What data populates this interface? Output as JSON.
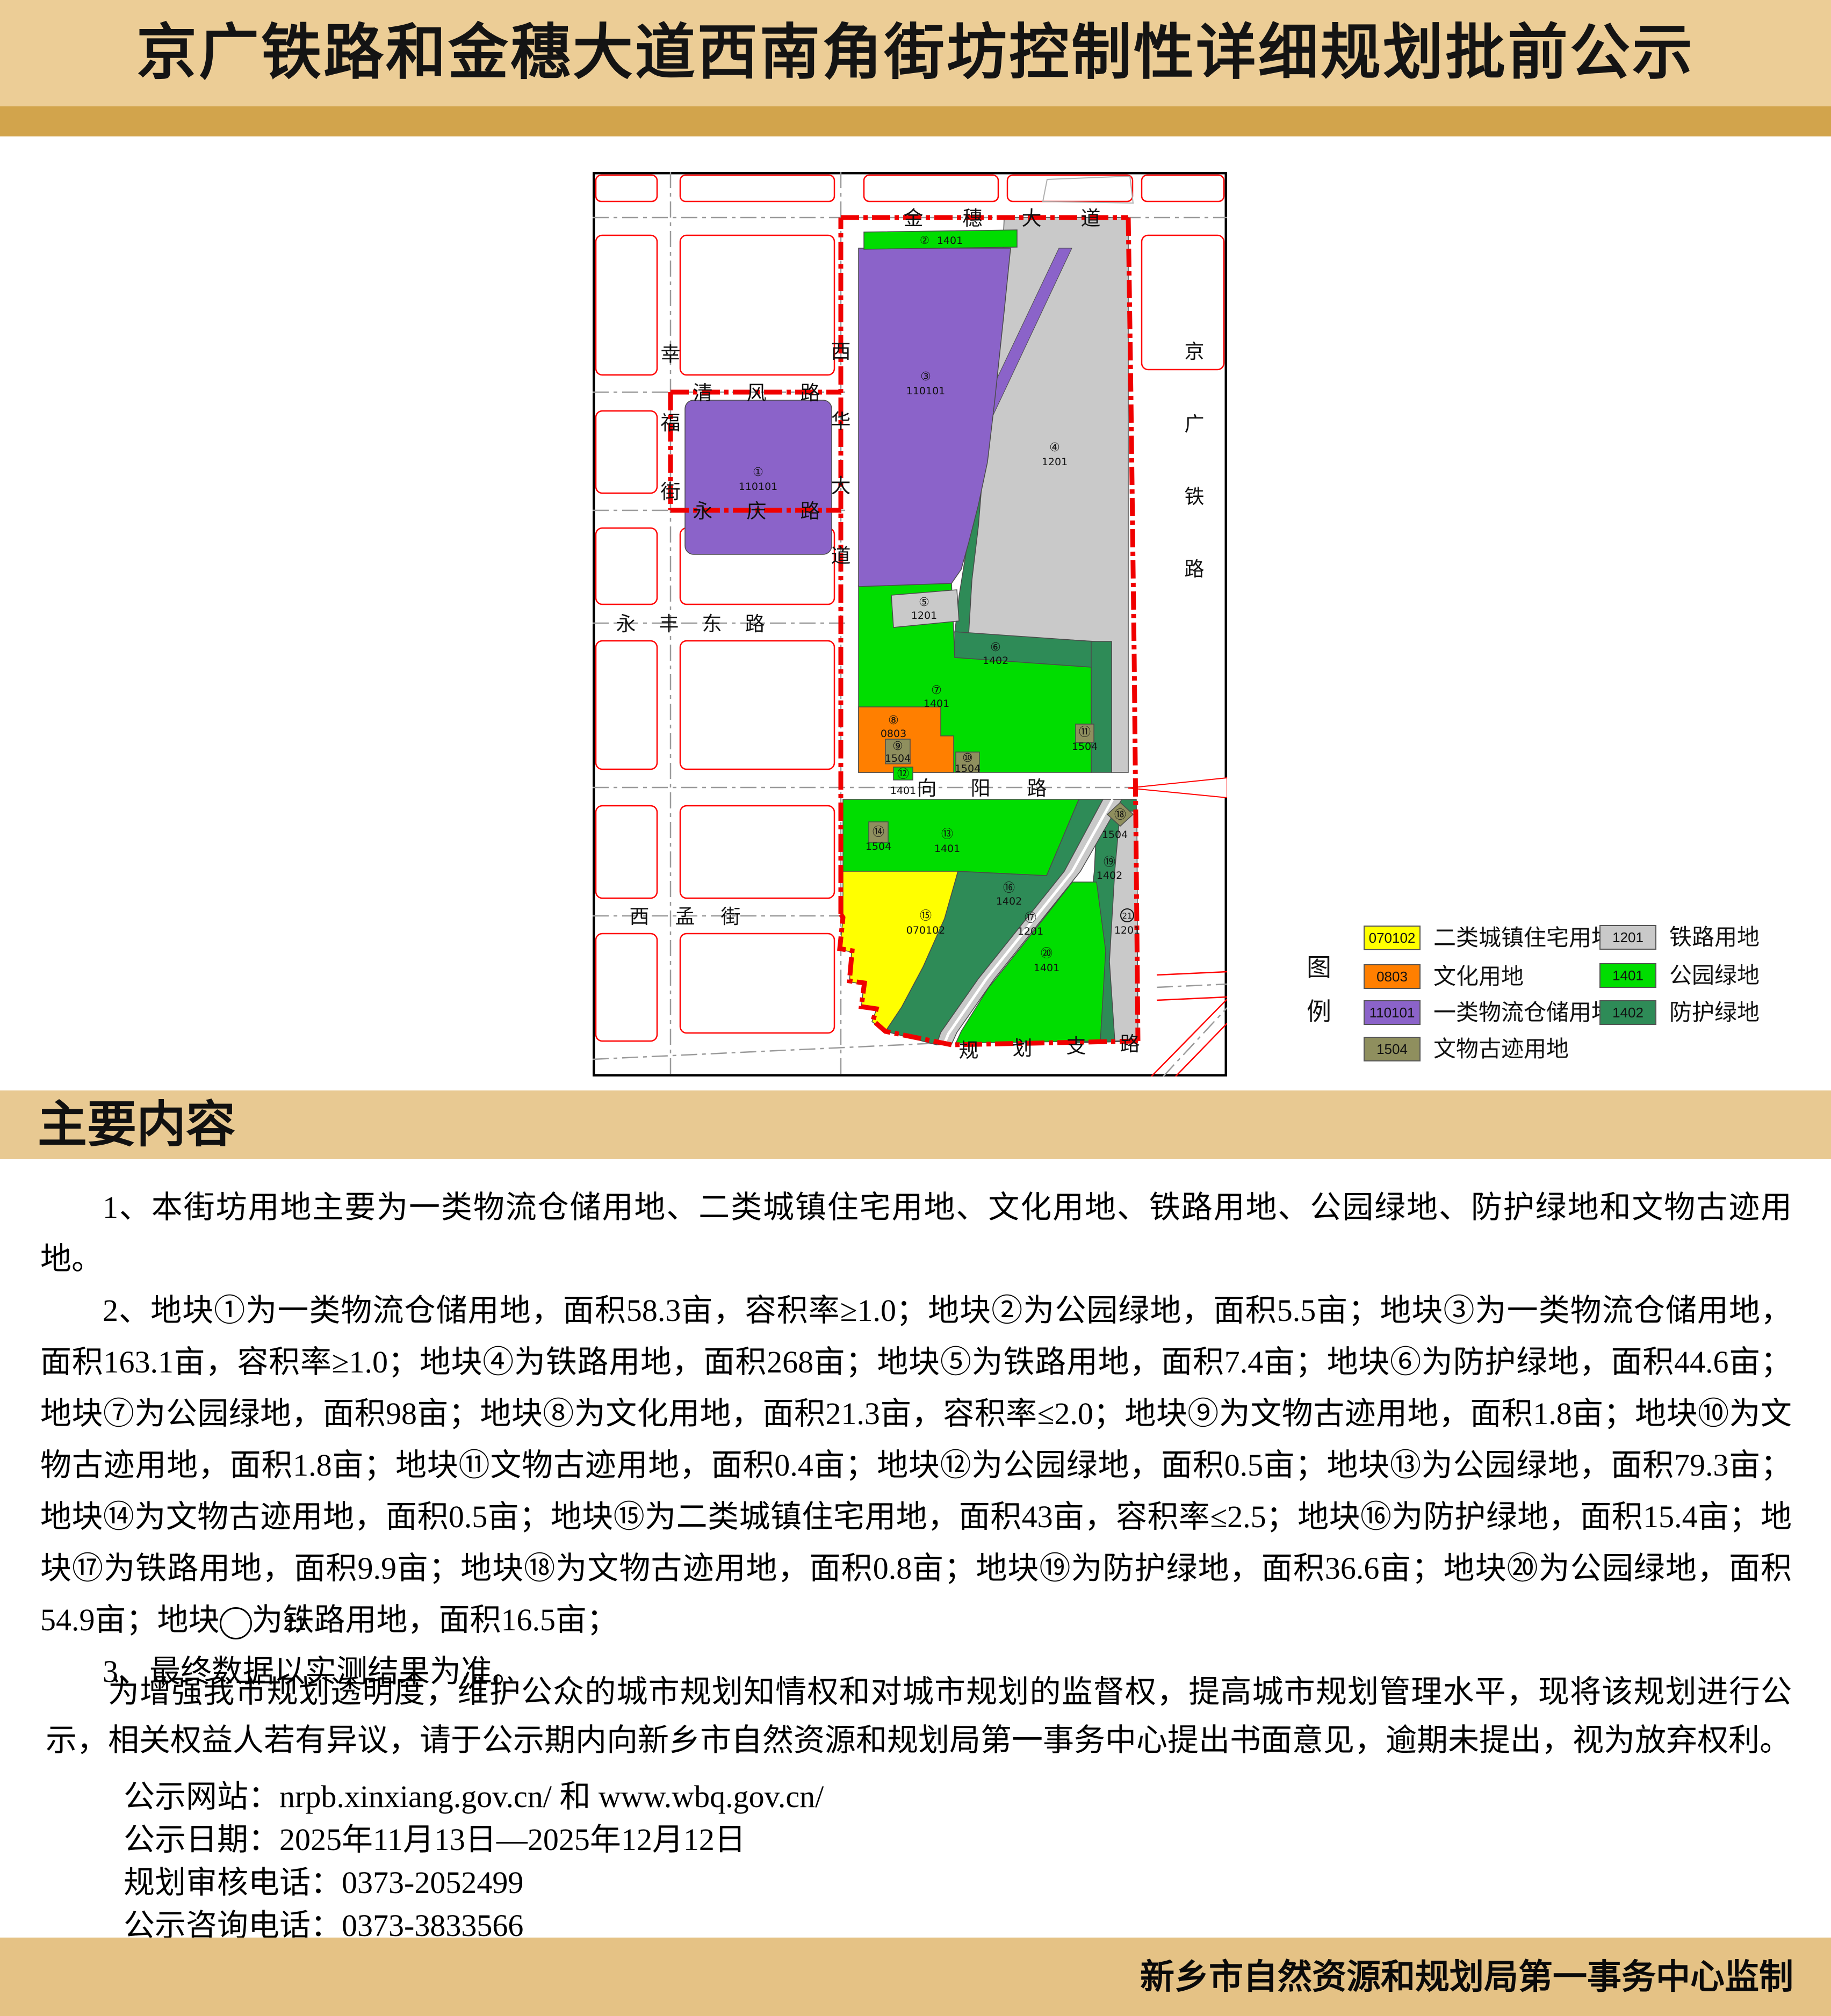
{
  "title": "京广铁路和金穗大道西南角街坊控制性详细规划批前公示",
  "section_header": "主要内容",
  "footer": "新乡市自然资源和规划局第一事务中心监制",
  "palette": {
    "residential": "#ffff00",
    "culture": "#ff7f00",
    "logistics": "#8b63c9",
    "heritage": "#8f8f5e",
    "railway": "#c9c9c9",
    "park": "#00dd00",
    "greenbelt": "#2e8b57",
    "boundary_red": "#f00000",
    "band_tan": "#eccd96",
    "band_gold": "#d2a44c"
  },
  "map": {
    "roads": {
      "jinsui": "金穗大道",
      "qingfeng": "清风路",
      "yongqing": "永庆路",
      "yongfengdong": "永丰东路",
      "xiangyang": "向阳路",
      "ximeng": "西孟街",
      "guihua": "规划支路",
      "xingfu": "幸福街",
      "xihua": "西华大道",
      "jingguang": "京广铁路"
    },
    "parcels": [
      {
        "num": "①",
        "code": "110101"
      },
      {
        "num": "②",
        "code": "1401"
      },
      {
        "num": "③",
        "code": "110101"
      },
      {
        "num": "④",
        "code": "1201"
      },
      {
        "num": "⑤",
        "code": "1201"
      },
      {
        "num": "⑥",
        "code": "1402"
      },
      {
        "num": "⑦",
        "code": "1401"
      },
      {
        "num": "⑧",
        "code": "0803"
      },
      {
        "num": "⑨",
        "code": "1504"
      },
      {
        "num": "⑩",
        "code": "1504"
      },
      {
        "num": "⑪",
        "code": "1504"
      },
      {
        "num": "⑫",
        "code": "1401"
      },
      {
        "num": "⑬",
        "code": "1401"
      },
      {
        "num": "⑭",
        "code": "1504"
      },
      {
        "num": "⑮",
        "code": "070102"
      },
      {
        "num": "⑯",
        "code": "1402"
      },
      {
        "num": "⑰",
        "code": "1201"
      },
      {
        "num": "⑱",
        "code": "1504"
      },
      {
        "num": "⑲",
        "code": "1402"
      },
      {
        "num": "⑳",
        "code": "1401"
      },
      {
        "num": "㉑",
        "code": "1201",
        "num_plain": "21"
      }
    ]
  },
  "legend": {
    "title": "图例",
    "col1": [
      {
        "code": "070102",
        "label": "二类城镇住宅用地",
        "color": "#ffff00"
      },
      {
        "code": "0803",
        "label": "文化用地",
        "color": "#ff7f00"
      },
      {
        "code": "110101",
        "label": "一类物流仓储用地",
        "color": "#8b63c9"
      },
      {
        "code": "1504",
        "label": "文物古迹用地",
        "color": "#8f8f5e"
      }
    ],
    "col2": [
      {
        "code": "1201",
        "label": "铁路用地",
        "color": "#c9c9c9"
      },
      {
        "code": "1401",
        "label": "公园绿地",
        "color": "#00dd00"
      },
      {
        "code": "1402",
        "label": "防护绿地",
        "color": "#2e8b57"
      }
    ]
  },
  "paragraphs": {
    "p1": "1、本街坊用地主要为一类物流仓储用地、二类城镇住宅用地、文化用地、铁路用地、公园绿地、防护绿地和文物古迹用地。",
    "p2a": "2、地块①为一类物流仓储用地，面积58.3亩，容积率≥1.0；地块②为公园绿地，面积5.5亩；地块③为一类物流仓储用地，面积163.1亩，容积率≥1.0；地块④为铁路用地，面积268亩；地块⑤为铁路用地，面积7.4亩；地块⑥为防护绿地，面积44.6亩；地块⑦为公园绿地，面积98亩；地块⑧为文化用地，面积21.3亩，容积率≤2.0；地块⑨为文物古迹用地，面积1.8亩；地块⑩为文物古迹用地，面积1.8亩；地块⑪文物古迹用地，面积0.4亩；地块⑫为公园绿地，面积0.5亩；地块⑬为公园绿地，面积79.3亩；地块⑭为文物古迹用地，面积0.5亩；地块⑮为二类城镇住宅用地，面积43亩，容积率≤2.5；地块⑯为防护绿地，面积15.4亩；地块⑰为铁路用地，面积9.9亩；地块⑱为文物古迹用地，面积0.8亩；地块⑲为防护绿地，面积36.6亩；地块⑳为公园绿地，面积54.9亩；地块",
    "p2_c21": "21",
    "p2b": "为铁路用地，面积16.5亩；",
    "p3": "3、最终数据以实测结果为准。"
  },
  "notice": {
    "para": "为增强我市规划透明度，维护公众的城市规划知情权和对城市规划的监督权，提高城市规划管理水平，现将该规划进行公示，相关权益人若有异议，请于公示期内向新乡市自然资源和规划局第一事务中心提出书面意见，逾期未提出，视为放弃权利。",
    "lines": [
      "公示网站：nrpb.xinxiang.gov.cn/ 和 www.wbq.gov.cn/",
      "公示日期：2025年11月13日—2025年12月12日",
      "规划审核电话：0373-2052499",
      "公示咨询电话：0373-3833566"
    ]
  }
}
